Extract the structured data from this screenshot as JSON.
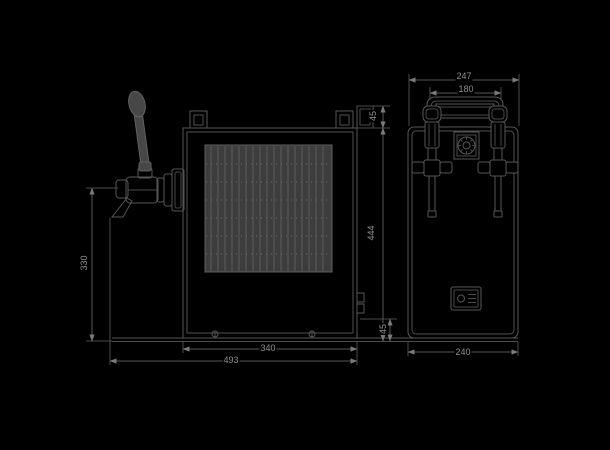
{
  "drawing": {
    "type": "technical-dimension-drawing",
    "subject": "two-tap beer dispenser cooler, front and side orthographic views",
    "colors": {
      "background": "#000000",
      "line": "#565656",
      "line_bright": "#6a6a6a",
      "grille_fill": "#3d3d3d",
      "handle_fill": "#474747",
      "label_text": "#8f8f8f"
    }
  },
  "views": {
    "front": {
      "label": "front-view",
      "dims": {
        "top_offset": "45",
        "height": "444",
        "base_height": "45",
        "faucet_height": "330",
        "body_width": "340",
        "overall_width": "493"
      }
    },
    "side": {
      "label": "side-view",
      "dims": {
        "overall_top_width": "247",
        "tap_spacing": "180",
        "depth": "240"
      }
    }
  }
}
